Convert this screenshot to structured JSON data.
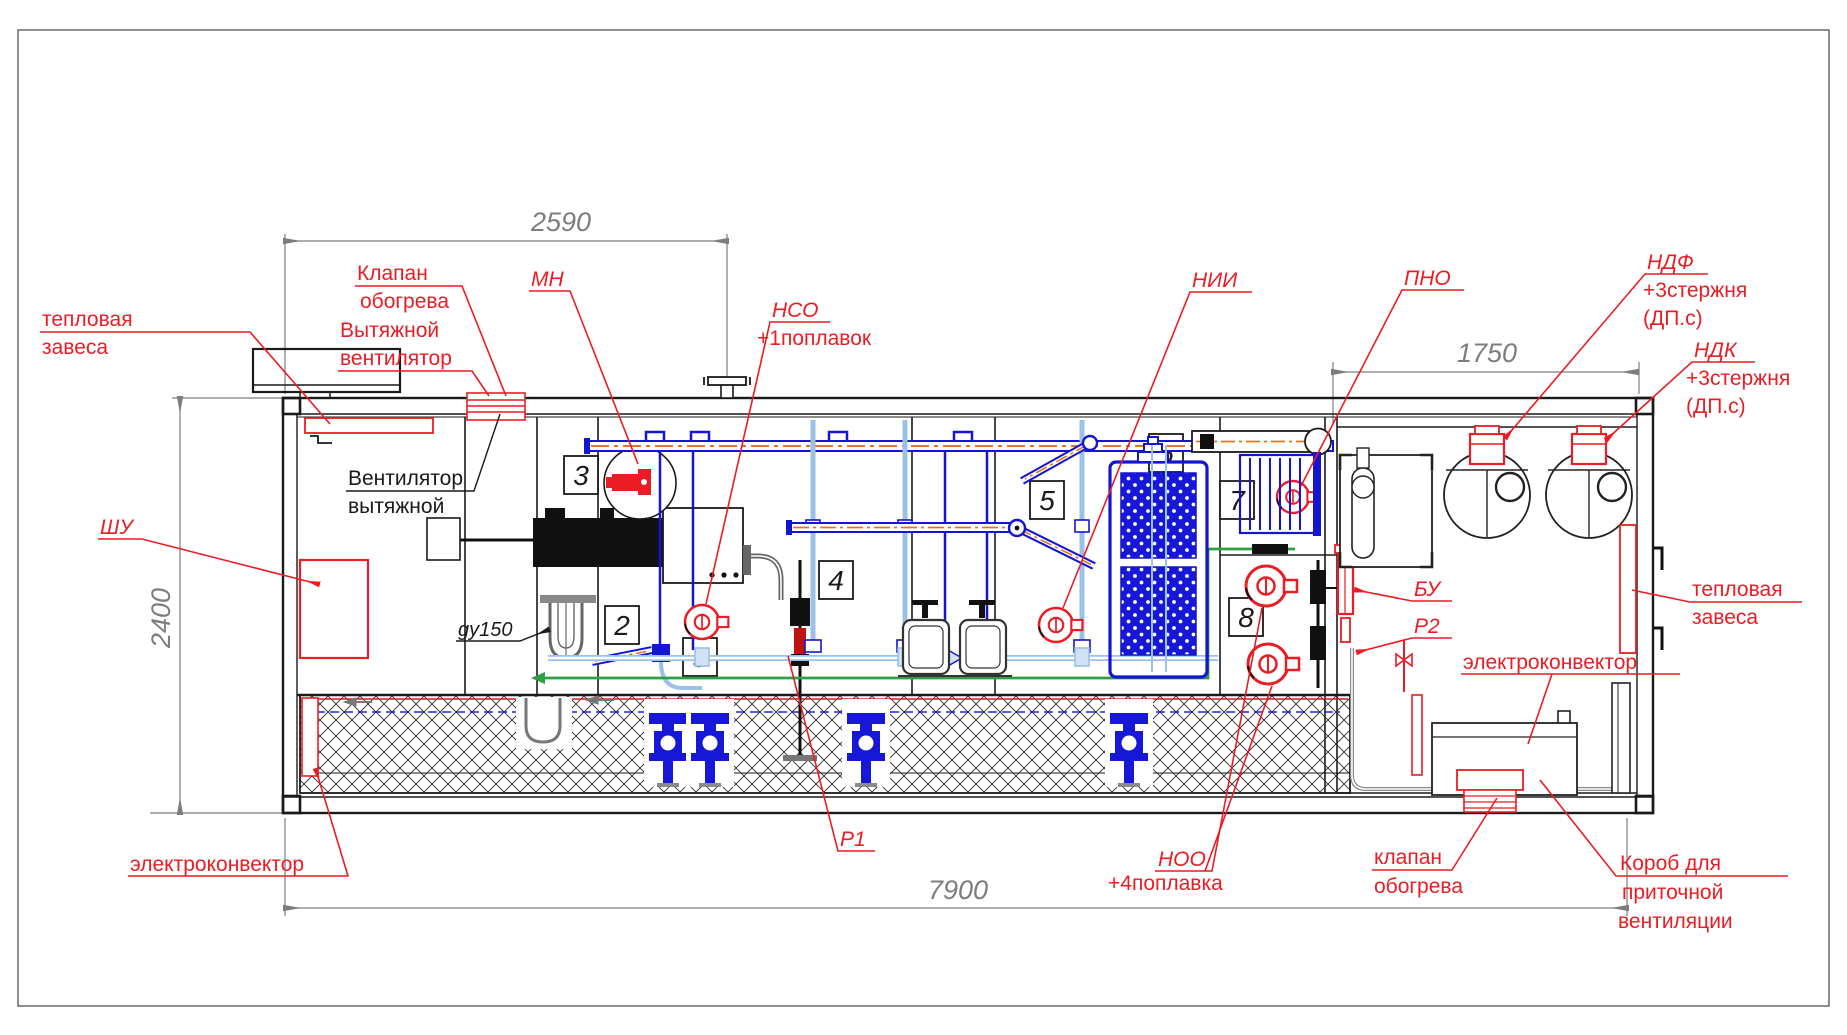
{
  "drawing_title": "container-module-equipment-layout",
  "dimensions": {
    "top": "2590",
    "right_top": "1750",
    "left": "2400",
    "bottom": "7900"
  },
  "sections": {
    "s2": "2",
    "s3": "3",
    "s4": "4",
    "s5": "5",
    "s6": "6",
    "s7": "7",
    "s8": "8",
    "s9": "9"
  },
  "labels": {
    "heat_curtain_left": {
      "l1": "тепловая",
      "l2": "завеса"
    },
    "valve_top": {
      "l1": "Клапан",
      "l2": "обогрева"
    },
    "exhaust_fan_red": {
      "l1": "Вытяжной",
      "l2": "вентилятор"
    },
    "exhaust_fan_black": {
      "l1": "Вентилятор",
      "l2": "вытяжной"
    },
    "mn": "МН",
    "nso": {
      "l1": "НСО",
      "l2": "+1поплавок"
    },
    "nii": "НИИ",
    "pno": "ПНО",
    "ndf": {
      "l1": "НДФ",
      "l2": "+3стержня",
      "l3": "(ДП.с)"
    },
    "ndk": {
      "l1": "НДК",
      "l2": "+3стержня",
      "l3": "(ДП.с)"
    },
    "shu": "ШУ",
    "gy150": "gy150",
    "p1": "Р1",
    "noo": {
      "l1": "НОО",
      "l2": "+4поплавка"
    },
    "bu": "БУ",
    "p2": "Р2",
    "electroconvector_left": "электроконвектор",
    "electroconvector_right": "электроконвектор",
    "heat_curtain_right": {
      "l1": "тепловая",
      "l2": "завеса"
    },
    "valve_bottom": {
      "l1": "клапан",
      "l2": "обогрева"
    },
    "supply_duct": {
      "l1": "Короб для",
      "l2": "приточной",
      "l3": "вентиляции"
    }
  },
  "colors": {
    "annotation_red": "#ec1c24",
    "pipe_blue": "#1414d2",
    "pipe_light_blue": "#9cc0e8",
    "pipe_green": "#2f9e44",
    "heat_orange": "#e07818",
    "dim_gray": "#7d7d7d",
    "line_black": "#1a1a1a"
  }
}
